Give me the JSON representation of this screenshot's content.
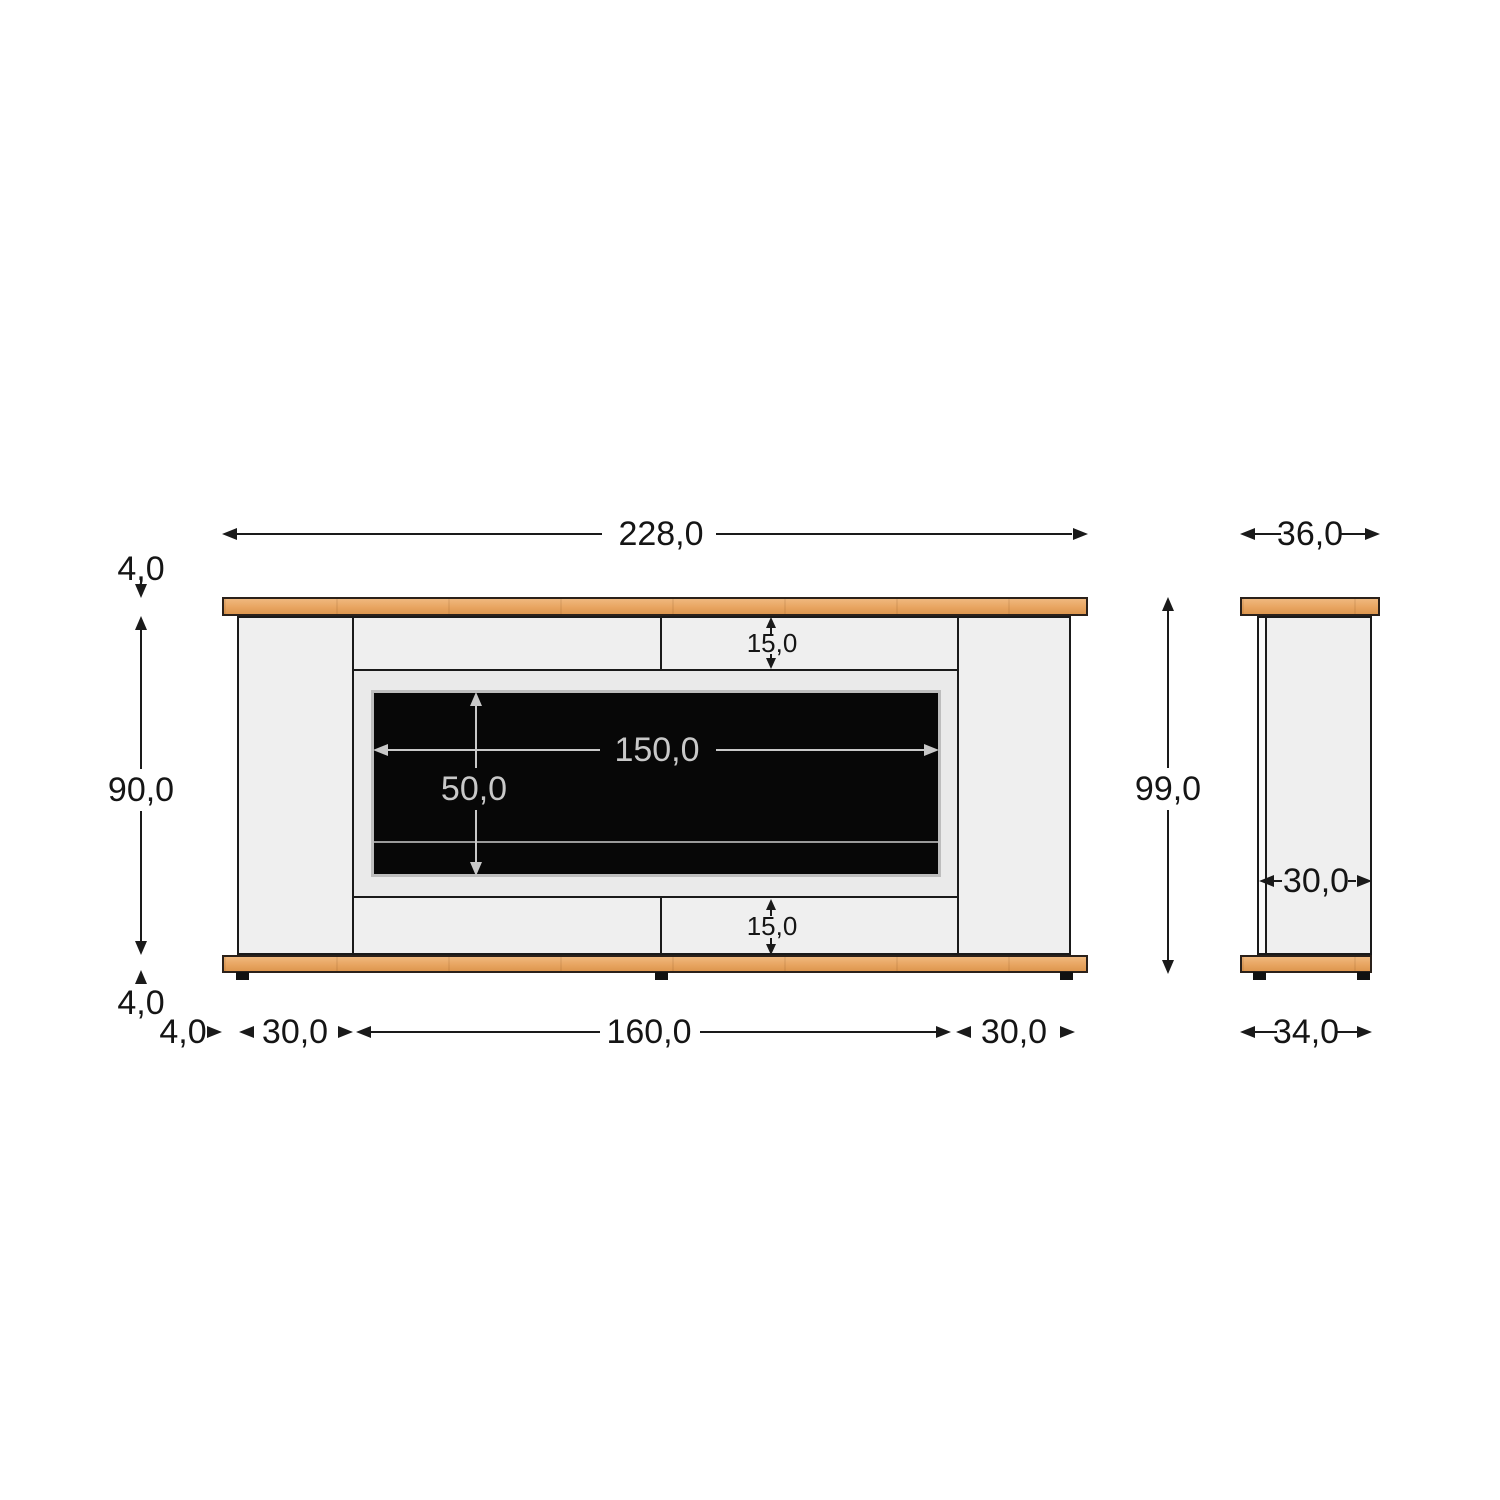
{
  "front_view": {
    "label_total_width": "228,0",
    "label_top_board_thickness": "4,0",
    "label_body_height": "90,0",
    "label_bottom_board_thickness": "4,0",
    "label_top_rail_height": "15,0",
    "label_bottom_rail_height": "15,0",
    "label_screen_width": "150,0",
    "label_screen_height": "50,0",
    "label_base_side_gap": "4,0",
    "label_left_pillar_width": "30,0",
    "label_opening_width": "160,0",
    "label_right_pillar_width": "30,0"
  },
  "side_view": {
    "label_top_depth": "36,0",
    "label_total_height": "99,0",
    "label_body_depth": "30,0",
    "label_base_depth": "34,0"
  },
  "colors": {
    "wood": "#e8a561",
    "body": "#efefef",
    "screen": "#070707",
    "line": "#1a1a1a",
    "dim_light": "#c8c8c8"
  }
}
